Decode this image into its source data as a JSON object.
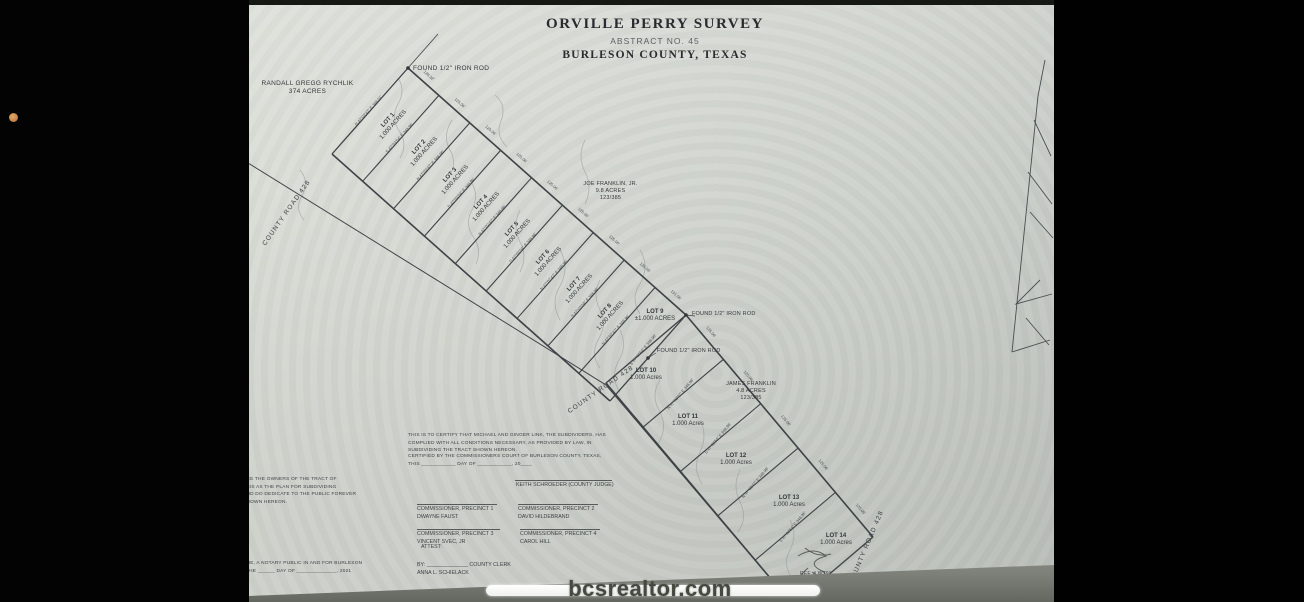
{
  "photo": {
    "watermark": "bcsrealtor.com",
    "accent_dot_color": "#c98a4e",
    "page_color": "#d6d9d3"
  },
  "plat": {
    "title": "ORVILLE PERRY SURVEY",
    "abstract": "ABSTRACT NO. 45",
    "county": "BURLESON COUNTY, TEXAS",
    "neighbors": {
      "northwest": [
        "RANDALL GREGG RYCHLIK",
        "374 ACRES"
      ],
      "northeast": [
        "JOE FRANKLIN, JR.",
        "9.8 ACRES",
        "123/385"
      ],
      "east": [
        "JAMES FRANKLIN",
        "4.8 ACRES",
        "123/385"
      ]
    },
    "monuments": {
      "top": "FOUND 1/2\" IRON ROD",
      "mid1": "FOUND 1/2\" IRON ROD",
      "mid2": "FOUND 1/2\" IRON ROD"
    },
    "road_label": "COUNTY ROAD 428",
    "ref_note": "REF. # W791",
    "lots": [
      {
        "name": "LOT 1",
        "area": "1.000 ACRES",
        "bearing": "N 47°02'47\" E  348.01'",
        "frontage": "128.32'"
      },
      {
        "name": "LOT 2",
        "area": "1.000 ACRES",
        "bearing": "S 47°03'54\" E  348.96'",
        "frontage": "125.06'"
      },
      {
        "name": "LOT 3",
        "area": "1.000 ACRES",
        "bearing": "N 47°02'47\" E  348.96'",
        "frontage": "125.06'"
      },
      {
        "name": "LOT 4",
        "area": "1.000 ACRES",
        "bearing": "S 47°03'54\" E  348.96'",
        "frontage": "125.06'"
      },
      {
        "name": "LOT 5",
        "area": "1.000 ACRES",
        "bearing": "N 47°02'47\" E  348.96'",
        "frontage": "125.06'"
      },
      {
        "name": "LOT 6",
        "area": "1.000 ACRES",
        "bearing": "S 47°03'54\" E  348.96'",
        "frontage": "125.06'"
      },
      {
        "name": "LOT 7",
        "area": "1.000 ACRES",
        "bearing": "N 47°02'47\" E  348.96'",
        "frontage": "125.06'"
      },
      {
        "name": "LOT 8",
        "area": "1.000 ACRES",
        "bearing": "S 47°03'54\" E  348.96'",
        "frontage": "125.06'"
      },
      {
        "name": "LOT 9",
        "area": "±1.000 ACRES",
        "bearing": "N 47°02'47\" E  348.96'",
        "frontage": "131.06'"
      },
      {
        "name": "LOT 10",
        "area": "1.000 Acres",
        "bearing": "S 47°03'54\" E  348.96'",
        "frontage": "125.06'"
      },
      {
        "name": "LOT 11",
        "area": "1.000 Acres",
        "bearing": "N 47°02'47\" E  348.96'",
        "frontage": "125.06'"
      },
      {
        "name": "LOT 12",
        "area": "1.000 Acres",
        "bearing": "S 47°03'54\" E  348.96'",
        "frontage": "125.06'"
      },
      {
        "name": "LOT 13",
        "area": "1.000 Acres",
        "bearing": "N 47°02'47\" E  348.96'",
        "frontage": "125.06'"
      },
      {
        "name": "LOT 14",
        "area": "1.000 Acres",
        "bearing": "S 47°03'54\" E  348.96'",
        "frontage": "125.06'"
      }
    ],
    "certification": {
      "lines": [
        "THIS IS TO CERTIFY THAT MICHAEL AND GINGER LINK, THE SUBDIVIDERS, HAS",
        "COMPLIED WITH ALL CONDITIONS NECESSARY, AS PROVIDED BY LAW, IN",
        "SUBDIVIDING THE TRACT SHOWN HEREON."
      ],
      "court_lines": [
        "CERTIFIED BY THE COMMISSIONERS COURT OF BURLESON COUNTY, TEXAS,",
        "THIS ____________ DAY OF ____________, 20____"
      ]
    },
    "owner_block": {
      "lines": [
        "ARE THE OWNERS OF THE TRACT OF",
        "THIS AS THE PLAN FOR SUBDIVIDING",
        "AND DO DEDICATE TO THE PUBLIC FOREVER",
        "SHOWN HEREON."
      ]
    },
    "notary_block": {
      "lines": [
        "ME, A NOTARY PUBLIC IN AND FOR BURLESON",
        "THE ______ DAY OF ______________, 2021"
      ]
    },
    "signatures": {
      "judge": "KEITH SCHROEDER (COUNTY JUDGE)",
      "precinct1": [
        "COMMISSIONER, PRECINCT 1",
        "DWAYNE FAUST"
      ],
      "precinct2": [
        "COMMISSIONER, PRECINCT 2",
        "DAVID HILDEBRAND"
      ],
      "precinct3": [
        "COMMISSIONER, PRECINCT 3",
        "VINCENT SVEC, JR"
      ],
      "precinct4": [
        "COMMISSIONER, PRECINCT 4",
        "CAROL HILL"
      ],
      "attest": "ATTEST:",
      "clerk": [
        "BY:  ______________ COUNTY CLERK",
        "ANNA L. SCHIELACK"
      ]
    }
  }
}
